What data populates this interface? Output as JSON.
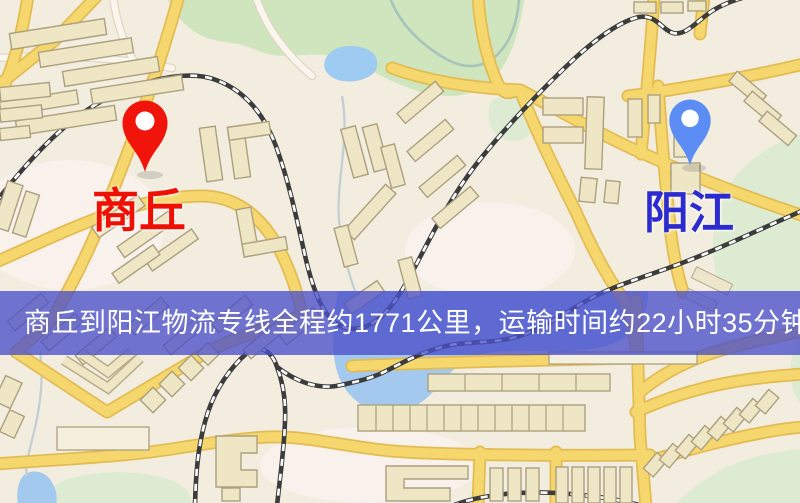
{
  "banner": {
    "text": "商丘到阳江物流专线全程约1771公里，运输时间约22小时35分钟.",
    "background": "#4A4FC9",
    "text_color": "#FFFFFF"
  },
  "markers": {
    "origin": {
      "label": "商丘",
      "label_color": "#EE1004",
      "pin_color": "#F0140B"
    },
    "destination": {
      "label": "阳江",
      "label_color": "#2B2BD0",
      "pin_color": "#5B8DF5"
    }
  },
  "map_colors": {
    "background": "#F2EDDF",
    "road": "#F6D76E",
    "road_casing": "#E2BC52",
    "minor_road": "#FAF6ED",
    "water": "#A3C9EE",
    "green": "#CFE5BD",
    "railway": "#3C3C3C",
    "building": "#EFE6C6"
  }
}
